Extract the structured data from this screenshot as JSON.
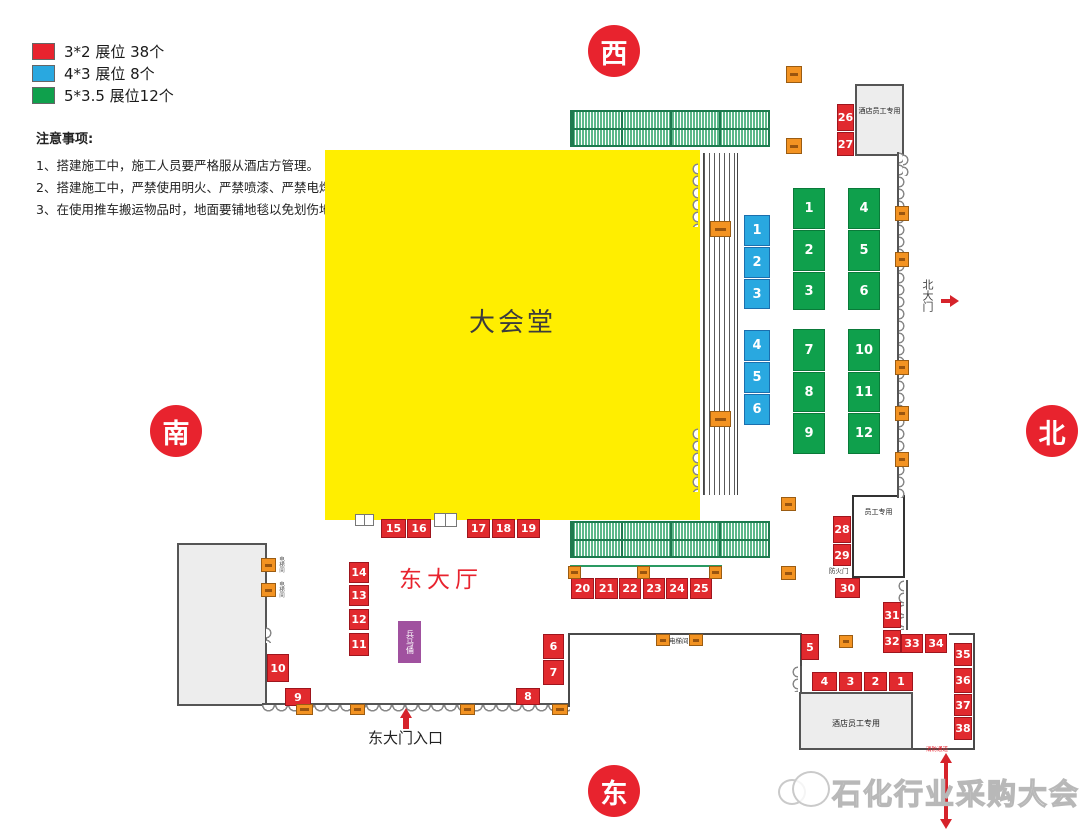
{
  "legend": {
    "items": [
      {
        "label": "3*2 展位 38个",
        "color": "#e8232e"
      },
      {
        "label": "4*3 展位 8个",
        "color": "#29a8e0"
      },
      {
        "label": "5*3.5 展位12个",
        "color": "#0fa04c"
      }
    ]
  },
  "notes": {
    "title": "注意事项:",
    "lines": [
      "1、搭建施工中，施工人员要严格服从酒店方管理。",
      "2、搭建施工中，严禁使用明火、严禁喷漆、严禁电焊操作。",
      "3、在使用推车搬运物品时，地面要铺地毯以免划伤地面。"
    ]
  },
  "compass": {
    "west": "西",
    "south": "南",
    "north": "北",
    "east": "东"
  },
  "hall": {
    "label": "大会堂"
  },
  "labels": {
    "east_hall": "东大厅",
    "east_entrance": "东大门入口",
    "north_gate": "北大门",
    "hotel_staff_top": "酒店员工专用",
    "staff_only": "员工专用",
    "hotel_staff_bottom": "酒店员工专用",
    "fire_door": "防火门",
    "elevator_mid": "电梯间",
    "elevator_left_top": "电梯间",
    "elevator_left_bottom": "电梯间",
    "terracotta": "兵马俑",
    "fire_passage": "消防通道"
  },
  "watermark": {
    "text": "石化行业采购大会"
  },
  "booths": {
    "red": [
      {
        "n": "26",
        "rect": [
          837,
          104,
          17,
          27
        ]
      },
      {
        "n": "27",
        "rect": [
          837,
          132,
          17,
          24
        ]
      },
      {
        "n": "28",
        "rect": [
          833,
          516,
          18,
          27
        ]
      },
      {
        "n": "29",
        "rect": [
          833,
          544,
          18,
          22
        ]
      },
      {
        "n": "30",
        "rect": [
          835,
          578,
          25,
          20
        ]
      },
      {
        "n": "31",
        "rect": [
          883,
          602,
          18,
          26
        ]
      },
      {
        "n": "32",
        "rect": [
          883,
          630,
          18,
          23
        ]
      },
      {
        "n": "33",
        "rect": [
          901,
          634,
          22,
          19
        ]
      },
      {
        "n": "34",
        "rect": [
          925,
          634,
          22,
          19
        ]
      },
      {
        "n": "35",
        "rect": [
          954,
          643,
          18,
          23
        ]
      },
      {
        "n": "36",
        "rect": [
          954,
          668,
          18,
          25
        ]
      },
      {
        "n": "37",
        "rect": [
          954,
          694,
          18,
          22
        ]
      },
      {
        "n": "38",
        "rect": [
          954,
          717,
          18,
          23
        ]
      },
      {
        "n": "15",
        "rect": [
          381,
          519,
          25,
          19
        ]
      },
      {
        "n": "16",
        "rect": [
          407,
          519,
          24,
          19
        ]
      },
      {
        "n": "17",
        "rect": [
          467,
          519,
          23,
          19
        ]
      },
      {
        "n": "18",
        "rect": [
          492,
          519,
          23,
          19
        ]
      },
      {
        "n": "19",
        "rect": [
          517,
          519,
          23,
          19
        ]
      },
      {
        "n": "20",
        "rect": [
          571,
          578,
          23,
          21
        ]
      },
      {
        "n": "21",
        "rect": [
          595,
          578,
          23,
          21
        ]
      },
      {
        "n": "22",
        "rect": [
          619,
          578,
          22,
          21
        ]
      },
      {
        "n": "23",
        "rect": [
          643,
          578,
          22,
          21
        ]
      },
      {
        "n": "24",
        "rect": [
          666,
          578,
          22,
          21
        ]
      },
      {
        "n": "25",
        "rect": [
          690,
          578,
          22,
          21
        ]
      },
      {
        "n": "14",
        "rect": [
          349,
          562,
          20,
          21
        ]
      },
      {
        "n": "13",
        "rect": [
          349,
          585,
          20,
          21
        ]
      },
      {
        "n": "12",
        "rect": [
          349,
          609,
          20,
          21
        ]
      },
      {
        "n": "11",
        "rect": [
          349,
          633,
          20,
          23
        ]
      },
      {
        "n": "10",
        "rect": [
          267,
          654,
          22,
          28
        ]
      },
      {
        "n": "9",
        "rect": [
          285,
          688,
          26,
          18
        ]
      },
      {
        "n": "8",
        "rect": [
          516,
          688,
          24,
          17
        ]
      },
      {
        "n": "6",
        "rect": [
          543,
          634,
          21,
          25
        ]
      },
      {
        "n": "7",
        "rect": [
          543,
          660,
          21,
          25
        ]
      },
      {
        "n": "5",
        "rect": [
          801,
          634,
          18,
          26
        ]
      },
      {
        "n": "4",
        "rect": [
          812,
          672,
          25,
          19
        ]
      },
      {
        "n": "3",
        "rect": [
          839,
          672,
          23,
          19
        ]
      },
      {
        "n": "2",
        "rect": [
          864,
          672,
          23,
          19
        ]
      },
      {
        "n": "1",
        "rect": [
          889,
          672,
          24,
          19
        ]
      }
    ],
    "blue": [
      {
        "n": "1",
        "rect": [
          744,
          215,
          26,
          31
        ]
      },
      {
        "n": "2",
        "rect": [
          744,
          247,
          26,
          31
        ]
      },
      {
        "n": "3",
        "rect": [
          744,
          279,
          26,
          30
        ]
      },
      {
        "n": "4",
        "rect": [
          744,
          330,
          26,
          31
        ]
      },
      {
        "n": "5",
        "rect": [
          744,
          362,
          26,
          31
        ]
      },
      {
        "n": "6",
        "rect": [
          744,
          394,
          26,
          31
        ]
      }
    ],
    "green": [
      {
        "n": "1",
        "rect": [
          793,
          188,
          32,
          41
        ]
      },
      {
        "n": "2",
        "rect": [
          793,
          230,
          32,
          41
        ]
      },
      {
        "n": "3",
        "rect": [
          793,
          272,
          32,
          38
        ]
      },
      {
        "n": "4",
        "rect": [
          848,
          188,
          32,
          41
        ]
      },
      {
        "n": "5",
        "rect": [
          848,
          230,
          32,
          41
        ]
      },
      {
        "n": "6",
        "rect": [
          848,
          272,
          32,
          38
        ]
      },
      {
        "n": "7",
        "rect": [
          793,
          329,
          32,
          42
        ]
      },
      {
        "n": "8",
        "rect": [
          793,
          372,
          32,
          40
        ]
      },
      {
        "n": "9",
        "rect": [
          793,
          413,
          32,
          41
        ]
      },
      {
        "n": "10",
        "rect": [
          848,
          329,
          32,
          42
        ]
      },
      {
        "n": "11",
        "rect": [
          848,
          372,
          32,
          40
        ]
      },
      {
        "n": "12",
        "rect": [
          848,
          413,
          32,
          41
        ]
      }
    ]
  },
  "markers": {
    "orange": [
      [
        786,
        66,
        16,
        17
      ],
      [
        786,
        138,
        16,
        16
      ],
      [
        710,
        221,
        21,
        16
      ],
      [
        710,
        411,
        21,
        16
      ],
      [
        895,
        206,
        14,
        15
      ],
      [
        895,
        252,
        14,
        15
      ],
      [
        895,
        360,
        14,
        15
      ],
      [
        895,
        406,
        14,
        15
      ],
      [
        895,
        452,
        14,
        15
      ],
      [
        781,
        497,
        15,
        14
      ],
      [
        781,
        566,
        15,
        14
      ],
      [
        568,
        566,
        13,
        13
      ],
      [
        637,
        566,
        13,
        13
      ],
      [
        709,
        566,
        13,
        13
      ],
      [
        656,
        634,
        14,
        12
      ],
      [
        689,
        634,
        14,
        12
      ],
      [
        839,
        635,
        14,
        13
      ],
      [
        261,
        558,
        15,
        14
      ],
      [
        261,
        583,
        15,
        14
      ],
      [
        296,
        704,
        17,
        11
      ],
      [
        350,
        704,
        15,
        11
      ],
      [
        460,
        704,
        15,
        11
      ],
      [
        552,
        704,
        16,
        11
      ]
    ]
  }
}
